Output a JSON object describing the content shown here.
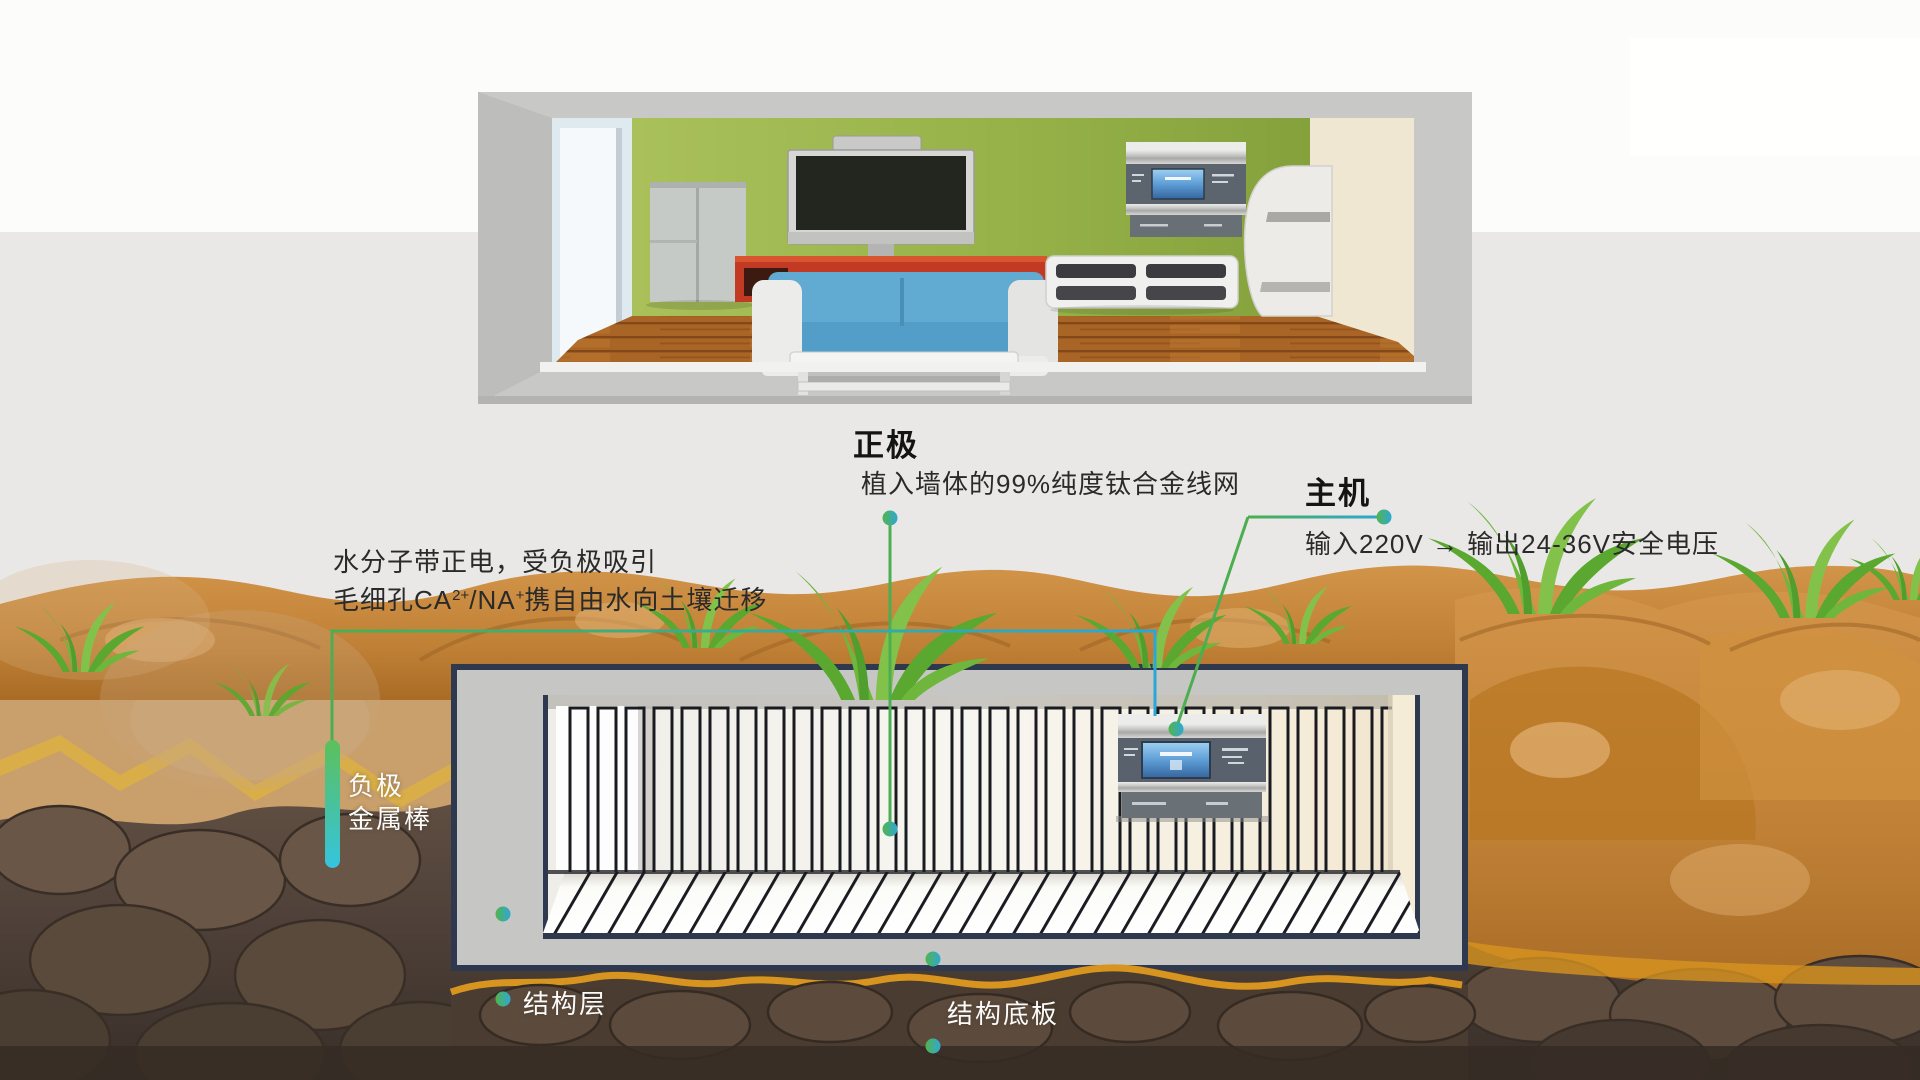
{
  "labels": {
    "positive": {
      "title": "正极",
      "desc": "植入墙体的99%纯度钛合金线网"
    },
    "host": {
      "title": "主机",
      "desc": "输入220V → 输出24-36V安全电压"
    },
    "mechanism": {
      "line1": "水分子带正电，受负极吸引",
      "line2_pre": "毛细孔CA",
      "line2_sup1": "2+",
      "line2_mid": "/NA",
      "line2_sup2": "+",
      "line2_post": "携自由水向土壤迁移"
    },
    "negative_electrode": {
      "line1": "负极",
      "line2": "金属棒"
    },
    "structure_layer": "结构层",
    "base_plate": "结构底板"
  },
  "colors": {
    "accent_green": "#4cae50",
    "accent_cyan": "#2aa7d6",
    "soil_orange": "#c98a42",
    "soil_dark": "#4a3c30",
    "frame_navy": "#2e3950",
    "wall_green": "#93ad42",
    "background_gray": "#e9e8e6"
  }
}
